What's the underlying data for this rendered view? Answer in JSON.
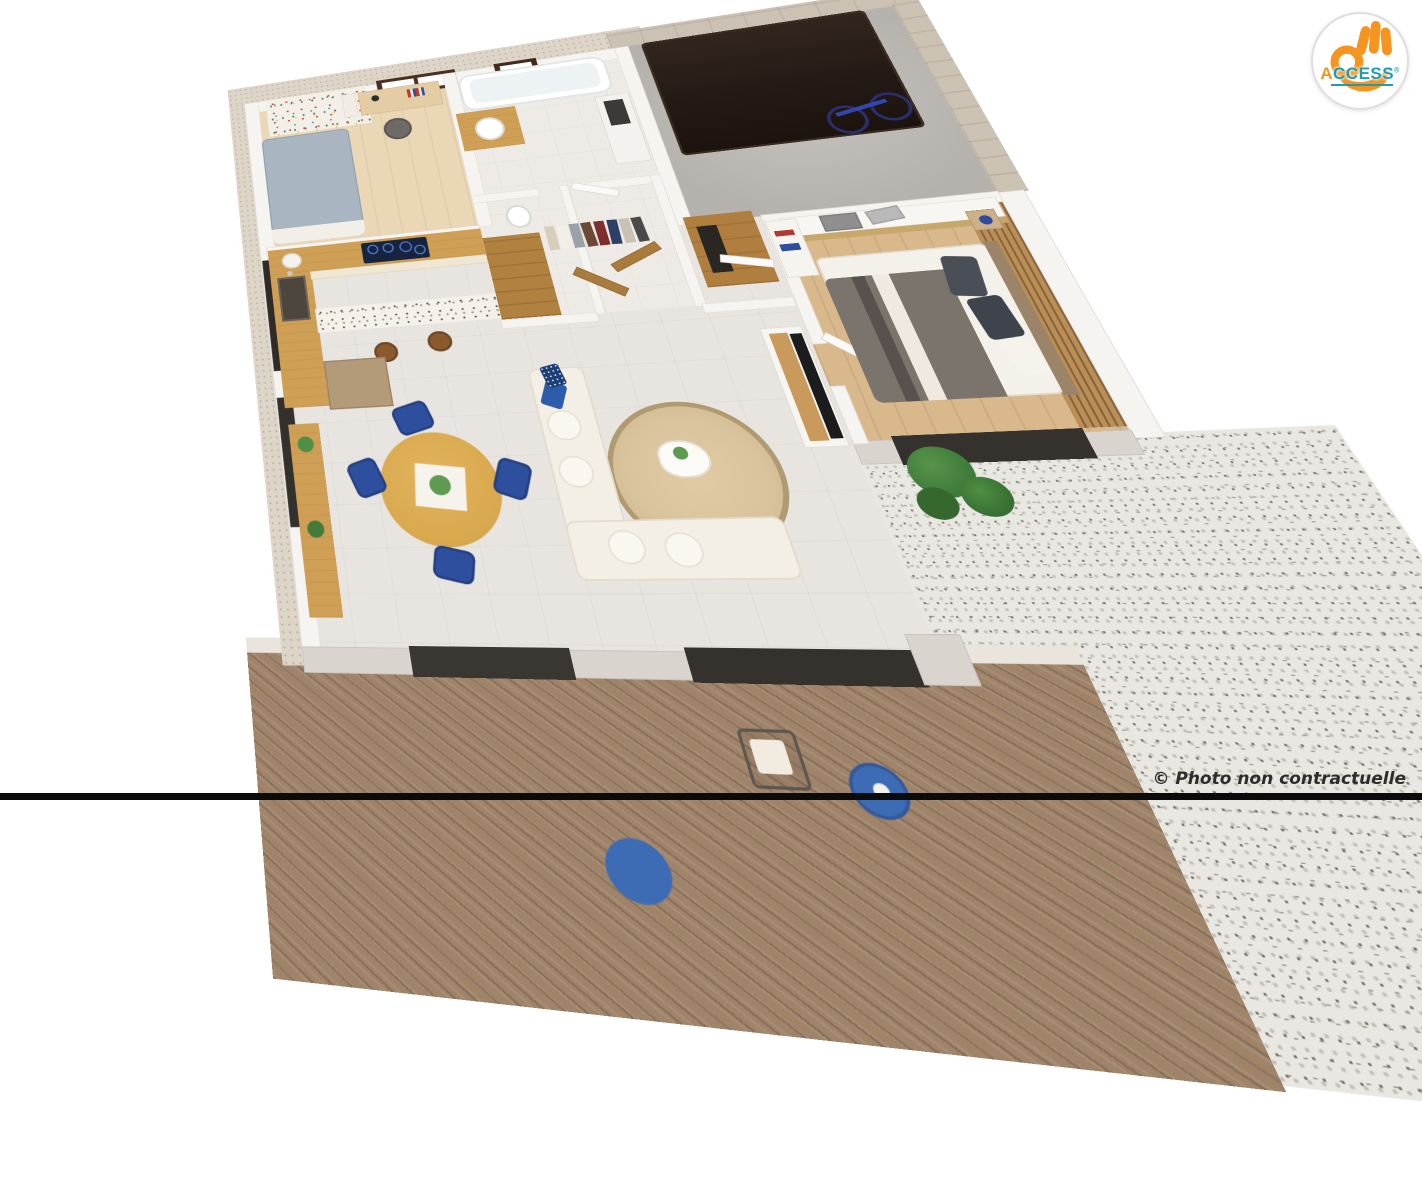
{
  "scene": {
    "type": "3D isometric dollhouse floor-plan render of a single-storey home, viewed from above",
    "rooms": [
      {
        "id": "bedroom-office",
        "label": "Bedroom / office",
        "floor": "light oak plank",
        "features": [
          "floral wallpaper accent wall",
          "dark-framed window",
          "desk with lamp and chair",
          "single bed with grey-blue duvet"
        ]
      },
      {
        "id": "kitchen",
        "label": "Kitchen",
        "floor": "pale stone tile",
        "features": [
          "L-shaped oak worktop",
          "induction hob with blue rings",
          "sink",
          "terrazzo breakfast bar",
          "two wooden stools",
          "tall oak cabinet",
          "doormat"
        ]
      },
      {
        "id": "dining",
        "label": "Dining area",
        "floor": "pale stone tile",
        "features": [
          "round oak table with flowers",
          "four navy-blue chairs",
          "oak console with plants"
        ]
      },
      {
        "id": "living",
        "label": "Living room",
        "floor": "pale stone tile",
        "features": [
          "cream corner sofa with navy cushions",
          "round jute rug",
          "white coffee table with plant",
          "TV sideboard with flat-screen TV"
        ]
      },
      {
        "id": "bathroom",
        "label": "Bathroom",
        "floor": "light tile",
        "features": [
          "bathtub",
          "round basin on oak vanity",
          "small dark-framed window",
          "storage niche"
        ]
      },
      {
        "id": "wc",
        "label": "WC",
        "floor": "light tile",
        "features": [
          "toilet"
        ]
      },
      {
        "id": "dressing",
        "label": "Dressing / hallway",
        "floor": "light tile",
        "features": [
          "oak wardrobe",
          "open rail with hanging clothes",
          "white interior doors"
        ]
      },
      {
        "id": "bedroom-master",
        "label": "Master bedroom",
        "floor": "oak plank",
        "features": [
          "double bed with taupe striped bedding",
          "wood-slat headboard wall",
          "nightstand with blue lamp",
          "white sliding wardrobe with folded grey towels",
          "open shelf unit"
        ]
      },
      {
        "id": "garage",
        "label": "Garage",
        "floor": "grey concrete",
        "features": [
          "dark brown sectional garage door",
          "travertine stone walls",
          "blue bicycle"
        ]
      },
      {
        "id": "terrace",
        "label": "Wooden deck terrace",
        "floor": "diagonal timber boards",
        "features": [
          "wire armchair with white cushion",
          "round blue side table",
          "blue seat"
        ]
      },
      {
        "id": "patio",
        "label": "Gravel patio",
        "floor": "white-grey terrazzo gravel",
        "features": [
          "green shrub"
        ]
      }
    ]
  },
  "logo": {
    "accent_letter": "A",
    "rest": "CCESS",
    "registered": "®",
    "hand_color": "#F5941F",
    "letter_color": "#1E9DB2",
    "accent_color": "#F5941F",
    "circle_fill": "#FFFFFF",
    "ring_color": "#DEDEDE"
  },
  "footer": {
    "copyright": "© Photo non contractuelle",
    "text_color": "#2F2D2B",
    "bottom_bar_color": "#0B0B0B"
  },
  "palette": {
    "background": "#FFFFFF",
    "tile": "#E8E4DF",
    "oak": "#CF9F55",
    "cream_cabinet": "#EFE7D2",
    "concrete": "#BDBAB6",
    "deck_wood": "#A0846A",
    "gravel": "#E9E7E2",
    "stone_wall": "#CCC2B4",
    "wall_white": "#F6F4F0",
    "garage_door": "#241A15",
    "accent_blue": "#2E4E9E"
  }
}
